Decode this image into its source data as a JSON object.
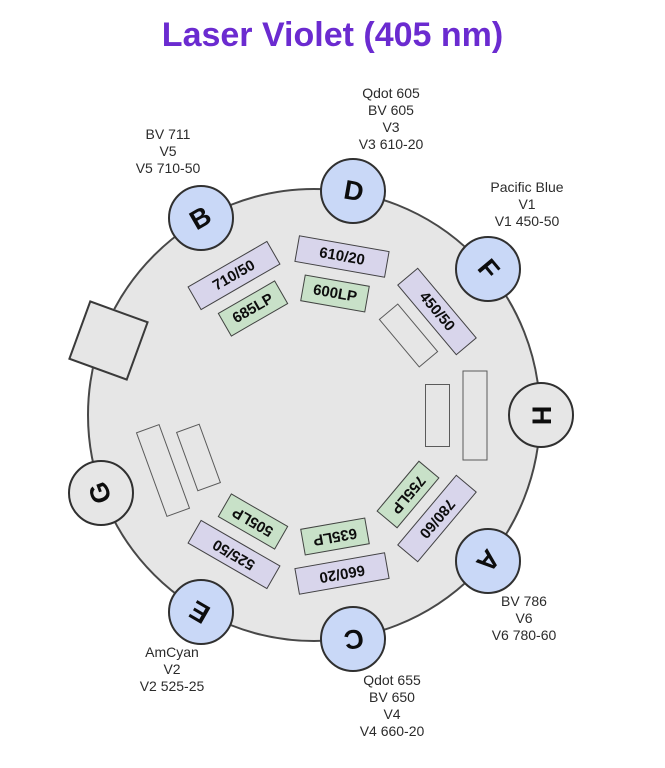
{
  "title": "Laser Violet (405 nm)",
  "colors": {
    "title": "#6b2bd0",
    "wheel_fill": "#e6e6e6",
    "detector_active_fill": "#c9d8f7",
    "detector_empty_fill": "#e6e6e6",
    "filter_bandpass_fill": "#d8d5eb",
    "filter_longpass_fill": "#c8e1c8",
    "filter_empty_fill": "#e6e6e6"
  },
  "wheel": {
    "detectors": [
      {
        "letter": "H",
        "angle": 0,
        "state": "empty"
      },
      {
        "letter": "F",
        "angle": 40,
        "state": "active"
      },
      {
        "letter": "D",
        "angle": 80,
        "state": "active"
      },
      {
        "letter": "B",
        "angle": 120,
        "state": "active"
      },
      {
        "letter": "G",
        "angle": 200,
        "state": "empty"
      },
      {
        "letter": "E",
        "angle": 240,
        "state": "active"
      },
      {
        "letter": "C",
        "angle": 280,
        "state": "active"
      },
      {
        "letter": "A",
        "angle": 320,
        "state": "active"
      }
    ],
    "blank_square": {
      "angle": 160
    },
    "filters": [
      {
        "label": "",
        "angle": 0,
        "ring": "outer",
        "kind": "empty"
      },
      {
        "label": "",
        "angle": 0,
        "ring": "inner",
        "kind": "empty"
      },
      {
        "label": "450/50",
        "angle": 40,
        "ring": "outer",
        "kind": "bandpass"
      },
      {
        "label": "",
        "angle": 40,
        "ring": "inner",
        "kind": "empty"
      },
      {
        "label": "610/20",
        "angle": 80,
        "ring": "outer",
        "kind": "bandpass"
      },
      {
        "label": "600LP",
        "angle": 80,
        "ring": "inner",
        "kind": "longpass"
      },
      {
        "label": "710/50",
        "angle": 120,
        "ring": "outer",
        "kind": "bandpass"
      },
      {
        "label": "685LP",
        "angle": 120,
        "ring": "inner",
        "kind": "longpass"
      },
      {
        "label": "",
        "angle": 200,
        "ring": "outer",
        "kind": "empty"
      },
      {
        "label": "",
        "angle": 200,
        "ring": "inner",
        "kind": "empty"
      },
      {
        "label": "525/50",
        "angle": 240,
        "ring": "outer",
        "kind": "bandpass"
      },
      {
        "label": "505LP",
        "angle": 240,
        "ring": "inner",
        "kind": "longpass"
      },
      {
        "label": "660/20",
        "angle": 280,
        "ring": "outer",
        "kind": "bandpass"
      },
      {
        "label": "635LP",
        "angle": 280,
        "ring": "inner",
        "kind": "longpass"
      },
      {
        "label": "780/60",
        "angle": 320,
        "ring": "outer",
        "kind": "bandpass"
      },
      {
        "label": "755LP",
        "angle": 320,
        "ring": "inner",
        "kind": "longpass"
      }
    ]
  },
  "fluor_labels": [
    {
      "detector": "B",
      "lines": [
        "BV 711",
        "V5",
        "V5 710-50"
      ]
    },
    {
      "detector": "D",
      "lines": [
        "Qdot 605",
        "BV 605",
        "V3",
        "V3 610-20"
      ]
    },
    {
      "detector": "F",
      "lines": [
        "Pacific Blue",
        "V1",
        "V1 450-50"
      ]
    },
    {
      "detector": "A",
      "lines": [
        "BV 786",
        "V6",
        "V6 780-60"
      ]
    },
    {
      "detector": "C",
      "lines": [
        "Qdot 655",
        "BV 650",
        "V4",
        "V4 660-20"
      ]
    },
    {
      "detector": "E",
      "lines": [
        "AmCyan",
        "V2",
        "V2 525-25"
      ]
    }
  ]
}
